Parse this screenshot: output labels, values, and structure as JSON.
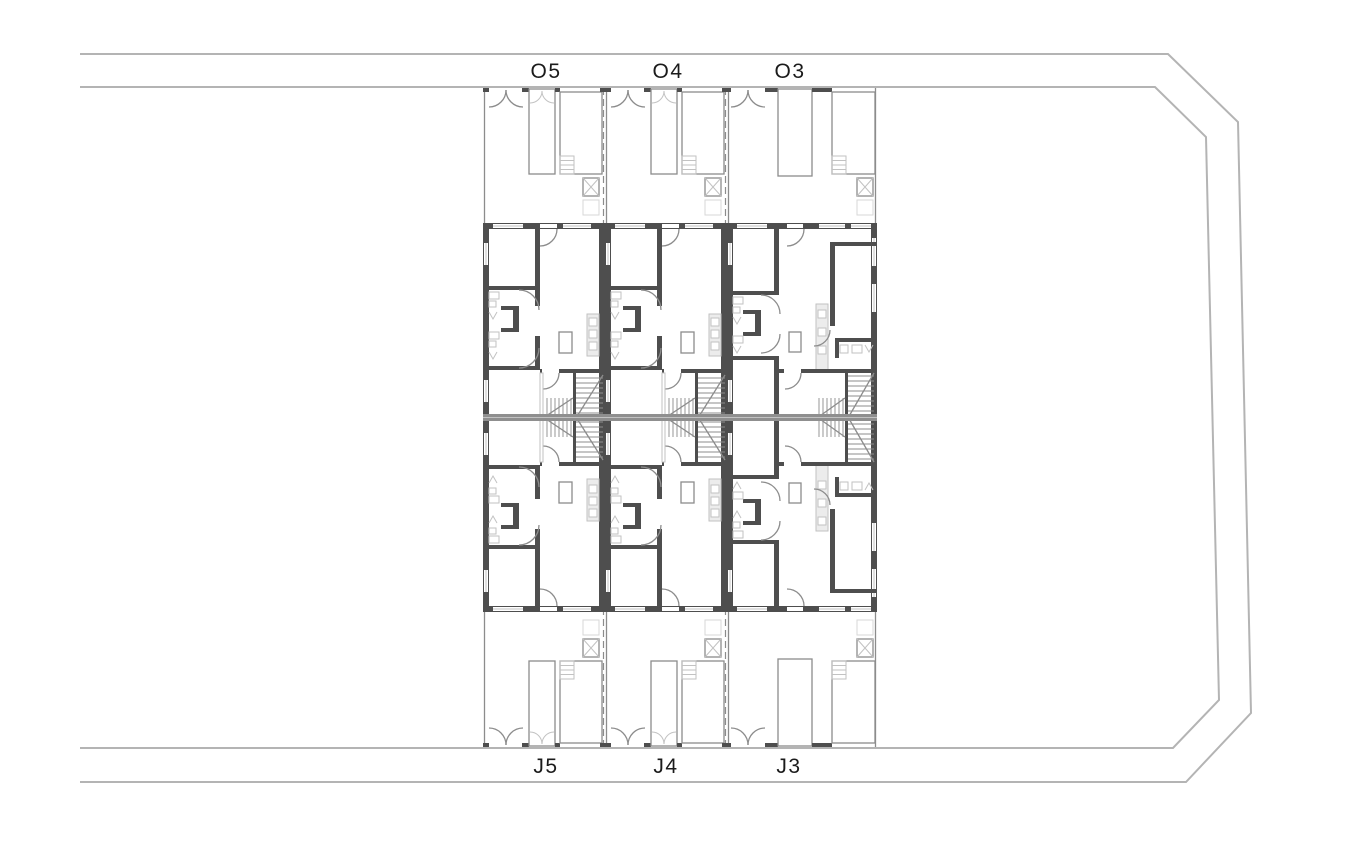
{
  "page": {
    "background": "#ffffff"
  },
  "colors": {
    "wall_dark": "#4e4e4e",
    "wall_light": "#8f8f8f",
    "line_medium": "#8c8c8c",
    "line_light": "#c2c2c2",
    "fill_light": "#ececec",
    "road_line": "#b4b4b4",
    "text": "#1b1b1b",
    "background": "#ffffff"
  },
  "plan": {
    "top_row": [
      {
        "id": "O5"
      },
      {
        "id": "O4"
      },
      {
        "id": "O3"
      }
    ],
    "bottom_row": [
      {
        "id": "J5"
      },
      {
        "id": "J4"
      },
      {
        "id": "J3"
      }
    ]
  }
}
